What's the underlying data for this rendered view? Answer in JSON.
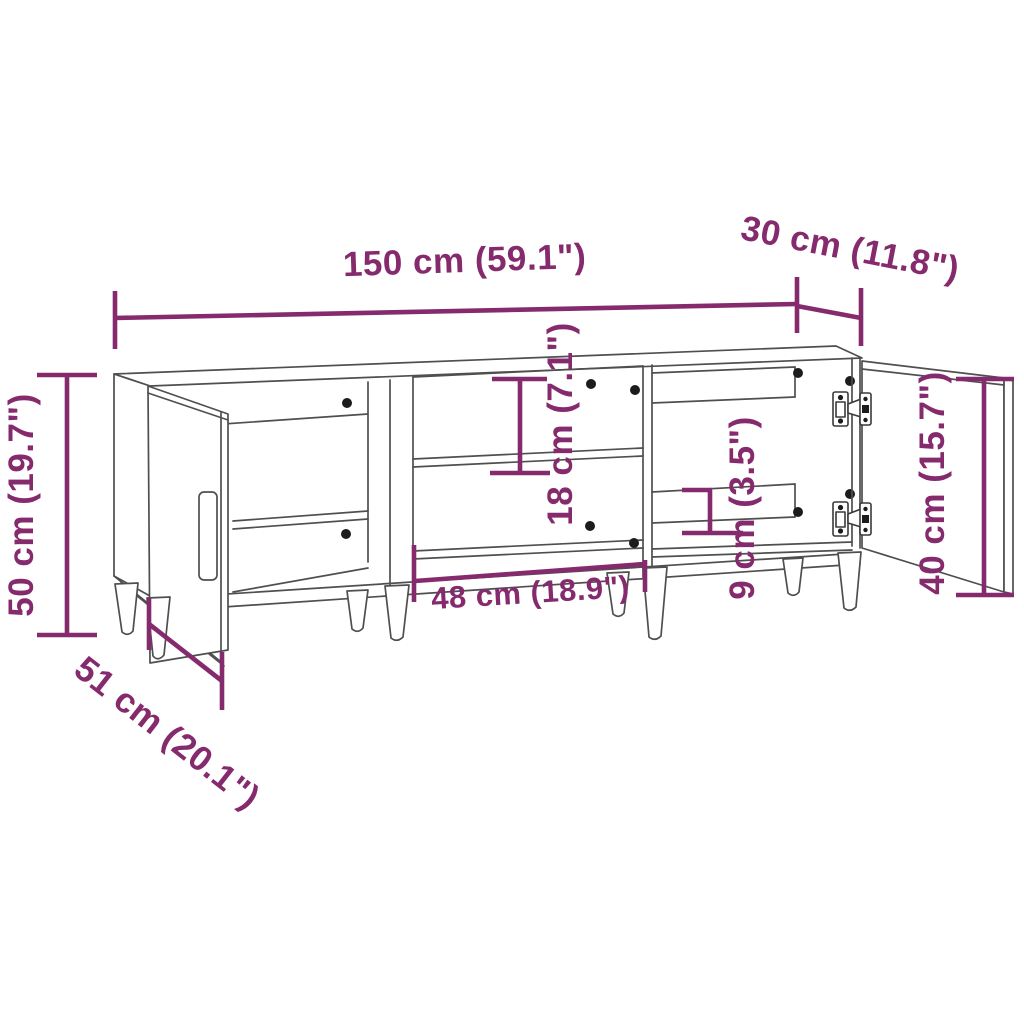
{
  "figure": {
    "title": "TV stand dimension diagram",
    "background_color": "#ffffff",
    "line_color": "#4f4f4f",
    "accent_color": "#862A6E",
    "annotations": {
      "width": {
        "label": "150 cm (59.1\")",
        "cm": 150,
        "inches": 59.1
      },
      "top_depth": {
        "label": "30 cm (11.8\")",
        "cm": 30,
        "inches": 11.8
      },
      "height": {
        "label": "50 cm (19.7\")",
        "cm": 50,
        "inches": 19.7
      },
      "total_depth": {
        "label": "51 cm (20.1\")",
        "cm": 51,
        "inches": 20.1
      },
      "opening_height": {
        "label": "18 cm (7.1\")",
        "cm": 18,
        "inches": 7.1
      },
      "opening_width": {
        "label": "48 cm (18.9\")",
        "cm": 48,
        "inches": 18.9
      },
      "rear_gap": {
        "label": "9 cm (3.5\")",
        "cm": 9,
        "inches": 3.5
      },
      "door_height": {
        "label": "40 cm (15.7\")",
        "cm": 40,
        "inches": 15.7
      }
    }
  }
}
